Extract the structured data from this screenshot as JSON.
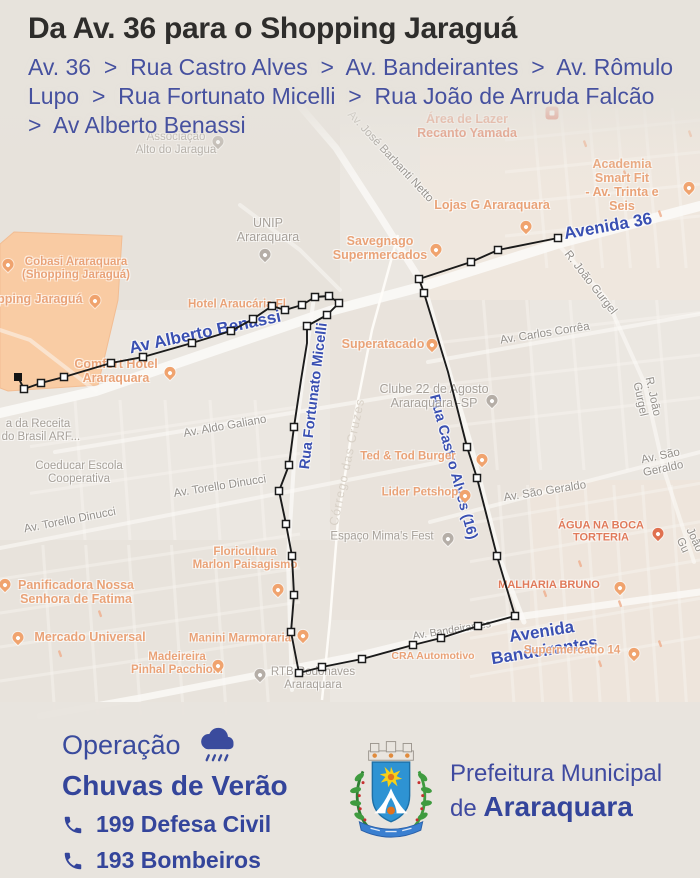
{
  "header": {
    "title": "Da Av. 36 para o Shopping Jaraguá",
    "route_lines": [
      "Av. 36  >  Rua Castro Alves  >  Av. Bandeirantes  >  Av. Rômulo",
      "Lupo  >  Rua Fortunato Micelli  >  Rua João de Arruda Falcão",
      ">  Av Alberto Benassi"
    ]
  },
  "map": {
    "colors": {
      "route": "#1b1b1b",
      "road": "#fbfaf7",
      "orange_area": "#fbca9f",
      "orange_area_border": "#f3ba8d",
      "blue_label": "#3a50b2"
    },
    "shopping_area": [
      [
        14,
        232
      ],
      [
        122,
        236
      ],
      [
        118,
        300
      ],
      [
        98,
        385
      ],
      [
        8,
        391
      ],
      [
        0,
        388
      ],
      [
        0,
        244
      ]
    ],
    "roads": [
      {
        "pts": [
          [
            700,
            206
          ],
          [
            560,
            243
          ],
          [
            424,
            286
          ],
          [
            330,
            311
          ],
          [
            96,
            391
          ],
          [
            0,
            413
          ]
        ],
        "w": 10,
        "o": 0.9
      },
      {
        "pts": [
          [
            300,
            106
          ],
          [
            336,
            148
          ],
          [
            380,
            216
          ],
          [
            424,
            286
          ]
        ],
        "w": 7,
        "o": 0.8
      },
      {
        "pts": [
          [
            424,
            286
          ],
          [
            452,
            382
          ],
          [
            470,
            442
          ],
          [
            500,
            560
          ],
          [
            524,
            622
          ]
        ],
        "w": 5,
        "o": 0.8
      },
      {
        "pts": [
          [
            700,
            592
          ],
          [
            516,
            617
          ],
          [
            360,
            655
          ],
          [
            140,
            698
          ],
          [
            40,
            716
          ]
        ],
        "w": 7,
        "o": 0.8
      },
      {
        "pts": [
          [
            314,
            297
          ],
          [
            296,
            430
          ],
          [
            288,
            560
          ],
          [
            292,
            690
          ]
        ],
        "w": 4,
        "o": 0.75
      },
      {
        "pts": [
          [
            556,
            242
          ],
          [
            606,
            298
          ],
          [
            644,
            382
          ],
          [
            664,
            470
          ],
          [
            694,
            562
          ]
        ],
        "w": 4,
        "o": 0.6
      },
      {
        "pts": [
          [
            428,
            362
          ],
          [
            700,
            314
          ]
        ],
        "w": 4,
        "o": 0.6
      },
      {
        "pts": [
          [
            430,
            522
          ],
          [
            700,
            452
          ]
        ],
        "w": 4,
        "o": 0.6
      },
      {
        "pts": [
          [
            55,
            452
          ],
          [
            430,
            390
          ]
        ],
        "w": 4,
        "o": 0.6
      },
      {
        "pts": [
          [
            0,
            548
          ],
          [
            440,
            462
          ]
        ],
        "w": 4,
        "o": 0.6
      },
      {
        "pts": [
          [
            96,
            391
          ],
          [
            30,
            340
          ],
          [
            0,
            330
          ]
        ],
        "w": 4,
        "o": 0.5
      },
      {
        "pts": [
          [
            240,
            205
          ],
          [
            300,
            250
          ],
          [
            340,
            290
          ]
        ],
        "w": 4,
        "o": 0.5
      }
    ],
    "stream": {
      "pts": [
        [
          398,
          235
        ],
        [
          372,
          330
        ],
        [
          352,
          430
        ],
        [
          338,
          520
        ],
        [
          330,
          620
        ],
        [
          322,
          700
        ]
      ],
      "w": 2.5
    },
    "route": {
      "points": [
        [
          558,
          238,
          1
        ],
        [
          498,
          250,
          1
        ],
        [
          471,
          262,
          1
        ],
        [
          419,
          279,
          1
        ],
        [
          424,
          293,
          1
        ],
        [
          448,
          372,
          0
        ],
        [
          467,
          447,
          1
        ],
        [
          477,
          478,
          1
        ],
        [
          497,
          556,
          1
        ],
        [
          515,
          616,
          1
        ],
        [
          478,
          626,
          1
        ],
        [
          441,
          638,
          1
        ],
        [
          413,
          645,
          1
        ],
        [
          362,
          659,
          1
        ],
        [
          322,
          667,
          1
        ],
        [
          299,
          673,
          1
        ],
        [
          291,
          632,
          1
        ],
        [
          294,
          595,
          1
        ],
        [
          292,
          556,
          1
        ],
        [
          286,
          524,
          1
        ],
        [
          279,
          491,
          1
        ],
        [
          289,
          465,
          1
        ],
        [
          294,
          427,
          1
        ],
        [
          301,
          380,
          0
        ],
        [
          307,
          343,
          0
        ],
        [
          307,
          326,
          1
        ],
        [
          327,
          315,
          1
        ],
        [
          339,
          303,
          1
        ],
        [
          329,
          296,
          1
        ],
        [
          315,
          297,
          1
        ],
        [
          302,
          305,
          1
        ],
        [
          285,
          310,
          1
        ],
        [
          272,
          306,
          1
        ],
        [
          253,
          319,
          1
        ],
        [
          231,
          331,
          1
        ],
        [
          192,
          343,
          1
        ],
        [
          143,
          357,
          1
        ],
        [
          111,
          363,
          1
        ],
        [
          64,
          377,
          1
        ],
        [
          41,
          383,
          1
        ],
        [
          24,
          389,
          1
        ],
        [
          18,
          377,
          2
        ]
      ]
    },
    "labels": [
      {
        "t": "Av. José Barbanti Netto",
        "x": 390,
        "y": 157,
        "r": 47,
        "c": "rg",
        "s": 11.5
      },
      {
        "t": "Av. Carlos Corrêa",
        "x": 545,
        "y": 334,
        "r": -9,
        "c": "rg",
        "s": 11.5
      },
      {
        "t": "R. João Gurgel",
        "x": 590,
        "y": 283,
        "r": 52,
        "c": "rg",
        "s": 11.5
      },
      {
        "t": "R. João Gurgel",
        "x": 646,
        "y": 398,
        "r": 78,
        "c": "rg",
        "s": 11.5
      },
      {
        "t": "R. João Gu",
        "x": 694,
        "y": 540,
        "r": 65,
        "c": "rg",
        "s": 11.5
      },
      {
        "t": "Av. São Geraldo",
        "x": 662,
        "y": 463,
        "r": -12,
        "c": "rg",
        "s": 11.5
      },
      {
        "t": "Av. São Geraldo",
        "x": 545,
        "y": 492,
        "r": -9,
        "c": "rg",
        "s": 11.5
      },
      {
        "t": "Av. Aldo Galiano",
        "x": 225,
        "y": 427,
        "r": -10,
        "c": "rg",
        "s": 11.5
      },
      {
        "t": "Av. Torello Dinucci",
        "x": 70,
        "y": 521,
        "r": -11,
        "c": "rg",
        "s": 11.5
      },
      {
        "t": "Av. Torello Dinucci",
        "x": 220,
        "y": 487,
        "r": -9,
        "c": "rg",
        "s": 11.5
      },
      {
        "t": "Av. Bandeirantes",
        "x": 452,
        "y": 631,
        "r": -9,
        "c": "rg",
        "s": 10.5
      },
      {
        "t": "Córrego das Cruzes",
        "x": 347,
        "y": 462,
        "r": -78,
        "c": "st",
        "s": 12.5
      },
      {
        "t": "Avenida 36",
        "x": 608,
        "y": 226,
        "r": -10,
        "c": "rb",
        "s": 17
      },
      {
        "t": "Av Alberto Benassi",
        "x": 205,
        "y": 332,
        "r": -12,
        "c": "rb",
        "s": 17
      },
      {
        "t": "Rua Fortunato Micelli",
        "x": 314,
        "y": 396,
        "r": -83,
        "c": "rb",
        "s": 14.5
      },
      {
        "t": "Rua Castro Alves (16)",
        "x": 453,
        "y": 467,
        "r": 75,
        "c": "rb",
        "s": 14.5
      },
      {
        "t": "Avenida Bandeirantes",
        "x": 543,
        "y": 641,
        "r": -9,
        "c": "rb",
        "s": 17
      },
      {
        "t": "Associação\nAlto do Jaragua",
        "x": 176,
        "y": 144,
        "r": 0,
        "c": "pg",
        "s": 11.5
      },
      {
        "t": "UNIP\nAraraquara",
        "x": 268,
        "y": 230,
        "r": 0,
        "c": "pg",
        "s": 12.5
      },
      {
        "t": "Clube 22 de Agosto\nAraraquara -SP",
        "x": 434,
        "y": 396,
        "r": 0,
        "c": "pg",
        "s": 12.5
      },
      {
        "t": "Espaço Mima's Fest",
        "x": 382,
        "y": 537,
        "r": 0,
        "c": "pg",
        "s": 11.5
      },
      {
        "t": "RTB Rodonaves\nAraraquara",
        "x": 313,
        "y": 679,
        "r": 0,
        "c": "pg",
        "s": 11.5
      },
      {
        "t": "Coeducar Escola\nCooperativa",
        "x": 79,
        "y": 473,
        "r": 0,
        "c": "pg",
        "s": 11.5
      },
      {
        "t": "a da Receita\nl do Brasil ARF...",
        "x": 38,
        "y": 431,
        "r": 0,
        "c": "pg",
        "s": 11.5
      },
      {
        "t": "Cobasi Araraquara\n(Shopping Jaraguá)",
        "x": 76,
        "y": 269,
        "r": 0,
        "c": "po",
        "s": 11.5
      },
      {
        "t": "Shopping Jaraguá",
        "x": 28,
        "y": 299,
        "r": 0,
        "c": "po",
        "s": 12.5
      },
      {
        "t": "Hotel Araucária Fl",
        "x": 237,
        "y": 305,
        "r": 0,
        "c": "po",
        "s": 11.5
      },
      {
        "t": "Comfort Hotel\nAraraquara",
        "x": 116,
        "y": 371,
        "r": 0,
        "c": "po",
        "s": 12.5
      },
      {
        "t": "Savegnago\nSupermercados",
        "x": 380,
        "y": 248,
        "r": 0,
        "c": "po",
        "s": 12.5
      },
      {
        "t": "Superatacado",
        "x": 383,
        "y": 344,
        "r": 0,
        "c": "po",
        "s": 12.5
      },
      {
        "t": "Lojas G Araraquara",
        "x": 492,
        "y": 205,
        "r": 0,
        "c": "po",
        "s": 12.5
      },
      {
        "t": "Academia Smart Fit\n- Av. Trinta e Seis",
        "x": 622,
        "y": 185,
        "r": 0,
        "c": "po",
        "s": 12.5
      },
      {
        "t": "Ted & Tod Burger",
        "x": 408,
        "y": 457,
        "r": 0,
        "c": "po",
        "s": 11.5
      },
      {
        "t": "Lider Petshop",
        "x": 420,
        "y": 493,
        "r": 0,
        "c": "po",
        "s": 11.5
      },
      {
        "t": "Panificadora Nossa\nSenhora de Fatima",
        "x": 76,
        "y": 592,
        "r": 0,
        "c": "po",
        "s": 12.5
      },
      {
        "t": "Mercado Universal",
        "x": 90,
        "y": 637,
        "r": 0,
        "c": "po",
        "s": 12.5
      },
      {
        "t": "Floricultura\nMarlon Paisagismo",
        "x": 245,
        "y": 559,
        "r": 0,
        "c": "po",
        "s": 11.5
      },
      {
        "t": "Manini Marmoraria",
        "x": 240,
        "y": 639,
        "r": 0,
        "c": "po",
        "s": 11.5
      },
      {
        "t": "Madeireira\nPinhal Pacchioni",
        "x": 177,
        "y": 664,
        "r": 0,
        "c": "po",
        "s": 11.5
      },
      {
        "t": "Supermercado 14",
        "x": 572,
        "y": 651,
        "r": 0,
        "c": "po",
        "s": 11.5
      },
      {
        "t": "CRA Automotivo",
        "x": 433,
        "y": 657,
        "r": 0,
        "c": "po",
        "s": 10.5
      },
      {
        "t": "Área de Lazer\nRecanto Yamada",
        "x": 467,
        "y": 126,
        "r": 0,
        "c": "pr",
        "s": 12.5
      },
      {
        "t": "ÁGUA NA BOCA\nTORTERIA",
        "x": 601,
        "y": 532,
        "r": 0,
        "c": "pr",
        "s": 11
      },
      {
        "t": "MALHARIA BRUNO",
        "x": 549,
        "y": 585,
        "r": 0,
        "c": "pr",
        "s": 11
      }
    ],
    "pins": [
      {
        "x": 218,
        "y": 146,
        "c": "g"
      },
      {
        "x": 265,
        "y": 259,
        "c": "g"
      },
      {
        "x": 8,
        "y": 269,
        "c": "o"
      },
      {
        "x": 95,
        "y": 305,
        "c": "o"
      },
      {
        "x": 436,
        "y": 254,
        "c": "o"
      },
      {
        "x": 432,
        "y": 349,
        "c": "o"
      },
      {
        "x": 526,
        "y": 231,
        "c": "o"
      },
      {
        "x": 689,
        "y": 192,
        "c": "o"
      },
      {
        "x": 170,
        "y": 377,
        "c": "o"
      },
      {
        "x": 492,
        "y": 405,
        "c": "g"
      },
      {
        "x": 482,
        "y": 464,
        "c": "o"
      },
      {
        "x": 465,
        "y": 500,
        "c": "o"
      },
      {
        "x": 448,
        "y": 543,
        "c": "g"
      },
      {
        "x": 5,
        "y": 589,
        "c": "o"
      },
      {
        "x": 18,
        "y": 642,
        "c": "o"
      },
      {
        "x": 278,
        "y": 594,
        "c": "o"
      },
      {
        "x": 303,
        "y": 640,
        "c": "o"
      },
      {
        "x": 218,
        "y": 670,
        "c": "o"
      },
      {
        "x": 260,
        "y": 679,
        "c": "g"
      },
      {
        "x": 634,
        "y": 658,
        "c": "o"
      },
      {
        "x": 658,
        "y": 538,
        "c": "r"
      },
      {
        "x": 620,
        "y": 592,
        "c": "o"
      }
    ],
    "area_icon": {
      "x": 552,
      "y": 113
    }
  },
  "footer": {
    "operation_label": "Operação",
    "operation_name": "Chuvas de Verão",
    "phones": [
      "199 Defesa Civil",
      "193 Bombeiros"
    ],
    "logo_line1": "Prefeitura Municipal",
    "logo_line2_prefix": "de ",
    "logo_line2_name": "Araraquara"
  }
}
